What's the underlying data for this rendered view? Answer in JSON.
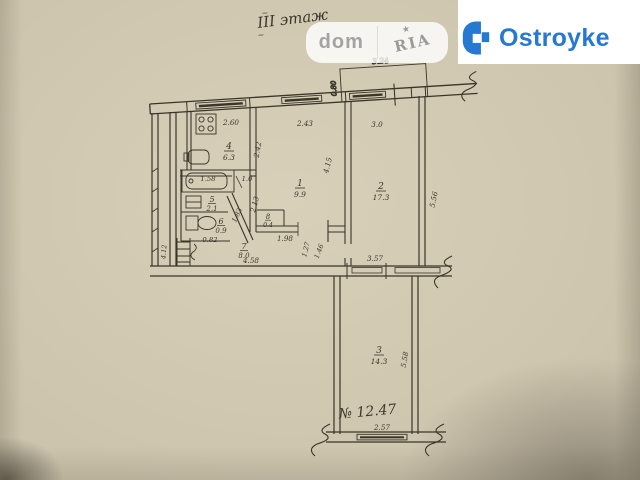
{
  "photo": {
    "floor_note": "III этаж",
    "case_note": "№ 12.47",
    "marks": {
      "tilde": "~"
    }
  },
  "watermark": {
    "dom": "dom",
    "ria": "RIA",
    "star": "★"
  },
  "brand": {
    "name": "Ostroyke",
    "color": "#2679d2"
  },
  "plan": {
    "rooms": {
      "room1": {
        "num": "1",
        "area": "9.9"
      },
      "room2": {
        "num": "2",
        "area": "17.3"
      },
      "room3": {
        "num": "3",
        "area": "14.3"
      },
      "kitchen": {
        "num": "4",
        "area": "6.3"
      },
      "bath": {
        "num": "5",
        "area": "2.1"
      },
      "wc": {
        "num": "6",
        "area": "0.9"
      },
      "hall": {
        "num": "7",
        "area": "8.0"
      },
      "closet": {
        "num": "8",
        "area": "0.4"
      }
    },
    "dims": {
      "balcony_width": "3.24",
      "balcony_depth": "0.80",
      "kitchen_width": "2.60",
      "room1_width": "2.43",
      "room2_width": "3.0",
      "kitchen_depth": "2.42",
      "room1_depth": "4.15",
      "room2_depth": "5.56",
      "tub_length": "1.58",
      "bath_door": "1.0",
      "bath_depth": "2.13",
      "bath_diagonal": "1.83",
      "wc_width": "0.82",
      "closet_width": "1.98",
      "hall_door_a": "1.27",
      "hall_door_b": "1.46",
      "room3_top_width": "3.57",
      "hall_width": "4.58",
      "stair_width": "4.12",
      "room3_depth": "5.58",
      "room3_window": "2.57"
    }
  }
}
